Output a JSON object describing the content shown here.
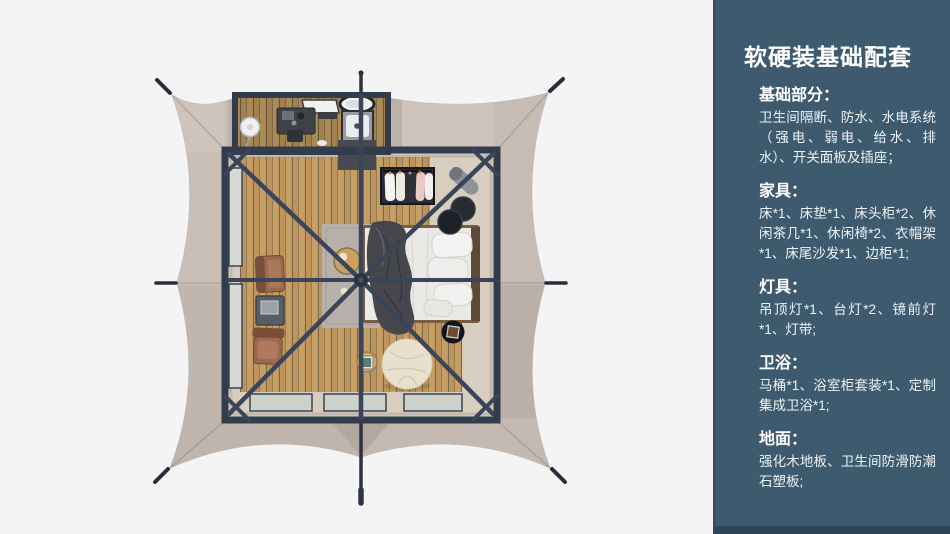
{
  "panel": {
    "title": "软硬装基础配套",
    "sections": [
      {
        "heading": "基础部分：",
        "body": "卫生间隔断、防水、水电系统（强电、弱电、给水、排水）、开关面板及插座；"
      },
      {
        "heading": "家具：",
        "body": "床*1、床垫*1、床头柜*2、休闲茶几*1、休闲椅*2、衣帽架*1、床尾沙发*1、边柜*1;"
      },
      {
        "heading": "灯具：",
        "body": "吊顶灯*1、台灯*2、镜前灯*1、灯带;"
      },
      {
        "heading": "卫浴：",
        "body": "马桶*1、浴室柜套装*1、定制集成卫浴*1;"
      },
      {
        "heading": "地面：",
        "body": "强化木地板、卫生间防滑防潮石塑板;"
      }
    ]
  },
  "colors": {
    "bg": "#f4f4f5",
    "panel-bg": "#3d5a6e",
    "panel-footer": "#2e4557",
    "panel-title": "#ffffff",
    "panel-text": "#eef3f6",
    "canvas": "#c5bbb3",
    "frame": "#333c4c",
    "floor": "#d8cec0",
    "wood": "#c79e63",
    "bed": "#ebe9e5",
    "blanket": "#46474c",
    "chair": "#9a6a50",
    "pouf": "#e8dfcd"
  }
}
